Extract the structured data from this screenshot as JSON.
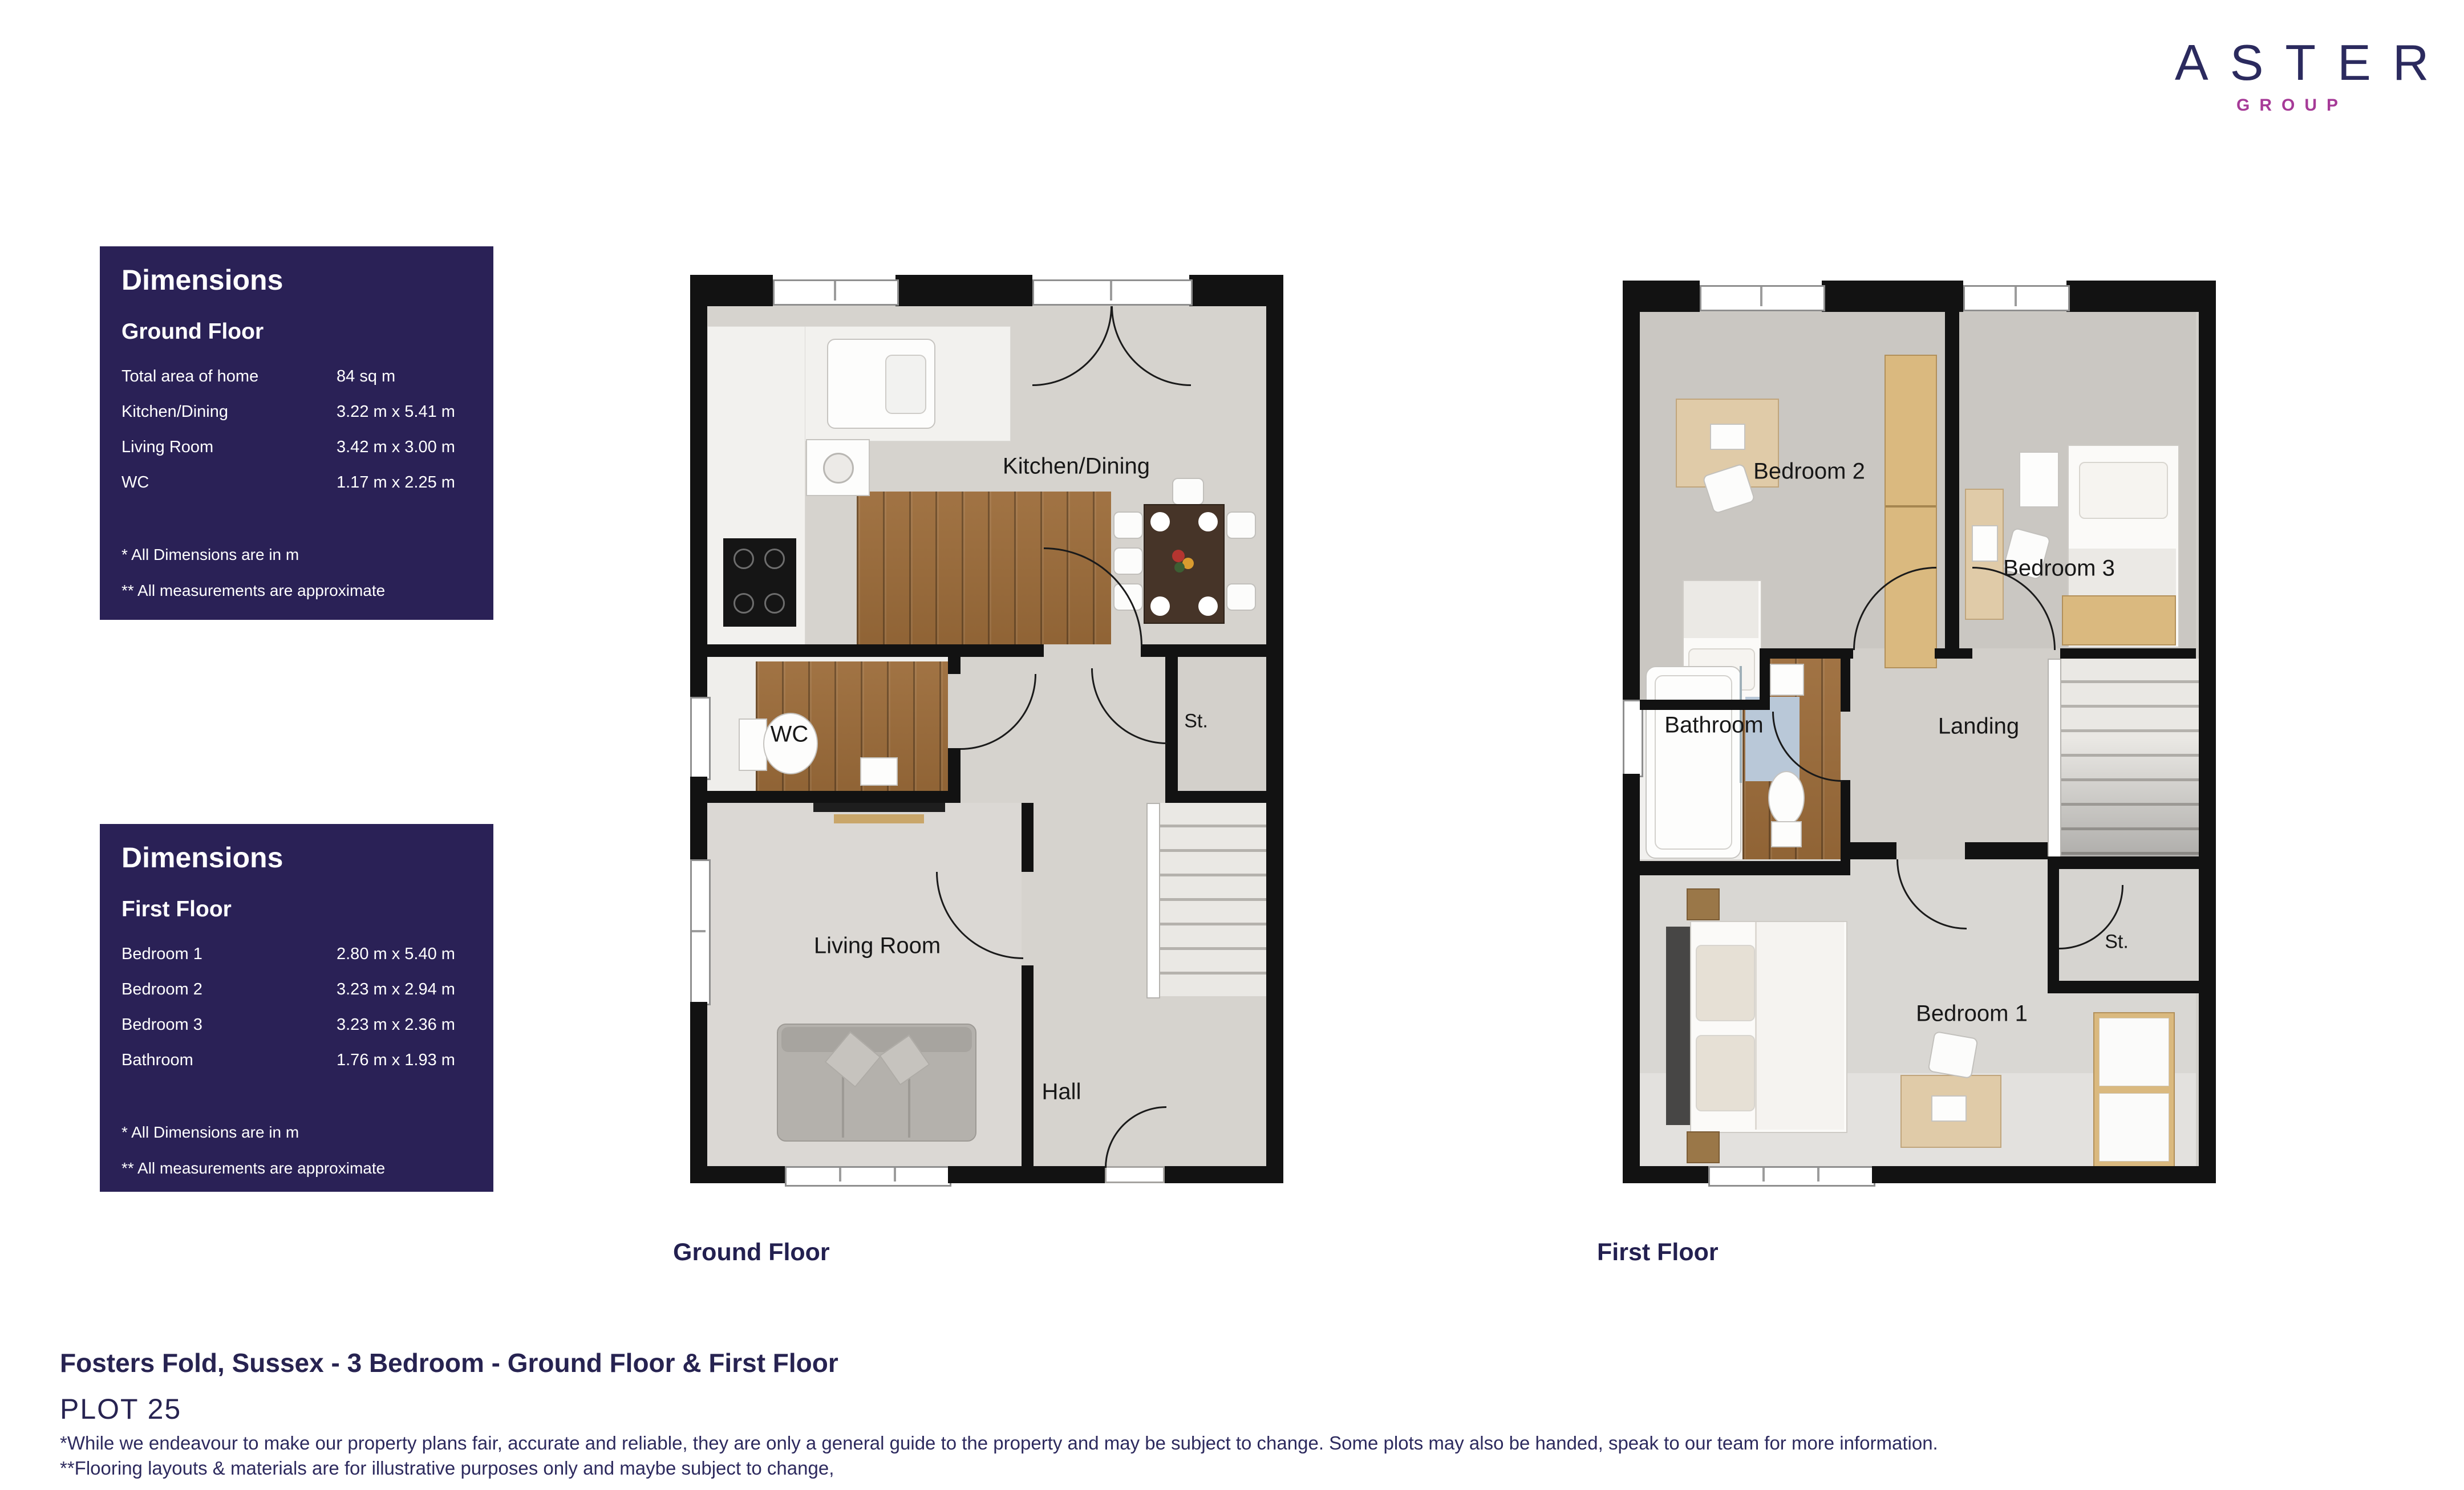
{
  "logo": {
    "brand": "ASTER",
    "group": "GROUP"
  },
  "dimensions_boxes": [
    {
      "title": "Dimensions",
      "floor": "Ground Floor",
      "rows": [
        {
          "label": "Total area of home",
          "value": "84 sq m"
        },
        {
          "label": "Kitchen/Dining",
          "value": "3.22 m x 5.41 m"
        },
        {
          "label": "Living Room",
          "value": "3.42 m x 3.00 m"
        },
        {
          "label": "WC",
          "value": "1.17 m x 2.25 m"
        }
      ],
      "notes": [
        "* All Dimensions are in m",
        "** All measurements are approximate"
      ]
    },
    {
      "title": "Dimensions",
      "floor": "First Floor",
      "rows": [
        {
          "label": "Bedroom 1",
          "value": "2.80 m x 5.40 m"
        },
        {
          "label": "Bedroom 2",
          "value": "3.23 m x 2.94 m"
        },
        {
          "label": "Bedroom 3",
          "value": "3.23 m x 2.36 m"
        },
        {
          "label": "Bathroom",
          "value": "1.76 m x 1.93 m"
        }
      ],
      "notes": [
        "* All Dimensions are in m",
        "** All measurements are approximate"
      ]
    }
  ],
  "ground_floor": {
    "caption": "Ground Floor",
    "labels": {
      "kitchen": "Kitchen/Dining",
      "st": "St.",
      "wc": "WC",
      "living": "Living Room",
      "hall": "Hall"
    }
  },
  "first_floor": {
    "caption": "First Floor",
    "labels": {
      "bedroom2": "Bedroom 2",
      "bedroom3": "Bedroom 3",
      "bathroom": "Bathroom",
      "landing": "Landing",
      "st": "St.",
      "bedroom1": "Bedroom 1"
    }
  },
  "footer": {
    "title": "Fosters Fold, Sussex - 3 Bedroom  - Ground Floor & First Floor",
    "plot": "PLOT 25",
    "disclaimers": [
      "*While we endeavour to make our property plans fair, accurate and reliable, they are only a general guide to the property and may be subject to change. Some plots may also be handed, speak to our team for more information.",
      "**Flooring layouts & materials are for illustrative purposes only and maybe subject to change,"
    ]
  },
  "colors": {
    "navy": "#272351",
    "magenta": "#a63a97",
    "panel": "#2a2156",
    "wall": "#121212",
    "wood": "#9c6c3a"
  }
}
